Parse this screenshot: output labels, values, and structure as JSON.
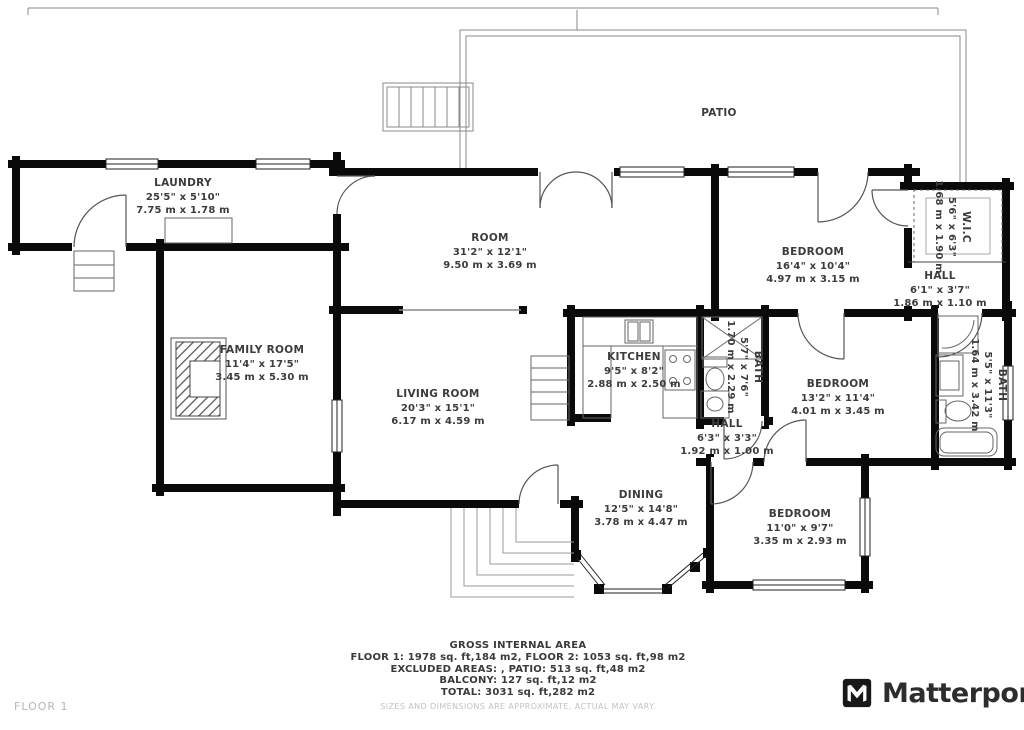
{
  "floor_label": "FLOOR 1",
  "brand": {
    "name": "Matterport",
    "icon": "matterport-m-icon"
  },
  "colors": {
    "wall": "#0a0a0a",
    "label_text": "#3c3c3c",
    "muted_text": "#c2c2c2",
    "brand_text": "#2d2d2d"
  },
  "rooms": [
    {
      "name": "LAUNDRY",
      "imperial": "25'5\" x 5'10\"",
      "metric": "7.75 m x 1.78 m"
    },
    {
      "name": "PATIO",
      "imperial": "",
      "metric": ""
    },
    {
      "name": "ROOM",
      "imperial": "31'2\" x 12'1\"",
      "metric": "9.50 m x 3.69 m"
    },
    {
      "name": "BEDROOM",
      "imperial": "16'4\" x 10'4\"",
      "metric": "4.97 m x 3.15 m"
    },
    {
      "name": "W.I.C",
      "imperial": "5'6\" x 6'3\"",
      "metric": "1.68 m x 1.90 m"
    },
    {
      "name": "HALL",
      "imperial": "6'1\" x 3'7\"",
      "metric": "1.86 m x 1.10 m"
    },
    {
      "name": "FAMILY ROOM",
      "imperial": "11'4\" x 17'5\"",
      "metric": "3.45 m x 5.30 m"
    },
    {
      "name": "LIVING ROOM",
      "imperial": "20'3\" x 15'1\"",
      "metric": "6.17 m x 4.59 m"
    },
    {
      "name": "KITCHEN",
      "imperial": "9'5\" x 8'2\"",
      "metric": "2.88 m x 2.50 m"
    },
    {
      "name": "BATH",
      "imperial": "5'7\" x 7'6\"",
      "metric": "1.70 m x 2.29 m"
    },
    {
      "name": "BEDROOM",
      "imperial": "13'2\" x 11'4\"",
      "metric": "4.01 m x 3.45 m"
    },
    {
      "name": "HALL",
      "imperial": "6'3\" x 3'3\"",
      "metric": "1.92 m x 1.00 m"
    },
    {
      "name": "BATH",
      "imperial": "5'5\" x 11'3\"",
      "metric": "1.64 m x 3.42 m"
    },
    {
      "name": "DINING",
      "imperial": "12'5\" x 14'8\"",
      "metric": "3.78 m x 4.47 m"
    },
    {
      "name": "BEDROOM",
      "imperial": "11'0\" x 9'7\"",
      "metric": "3.35 m x 2.93 m"
    }
  ],
  "footer": {
    "title": "GROSS INTERNAL AREA",
    "line1": "FLOOR 1: 1978 sq. ft,184 m2, FLOOR 2: 1053 sq. ft,98 m2",
    "line2": "EXCLUDED AREAS: , PATIO: 513 sq. ft,48 m2",
    "line3": "BALCONY: 127 sq. ft,12 m2",
    "line4": "TOTAL: 3031 sq. ft,282 m2",
    "disclaimer": "SIZES AND DIMENSIONS ARE APPROXIMATE, ACTUAL MAY VARY."
  }
}
